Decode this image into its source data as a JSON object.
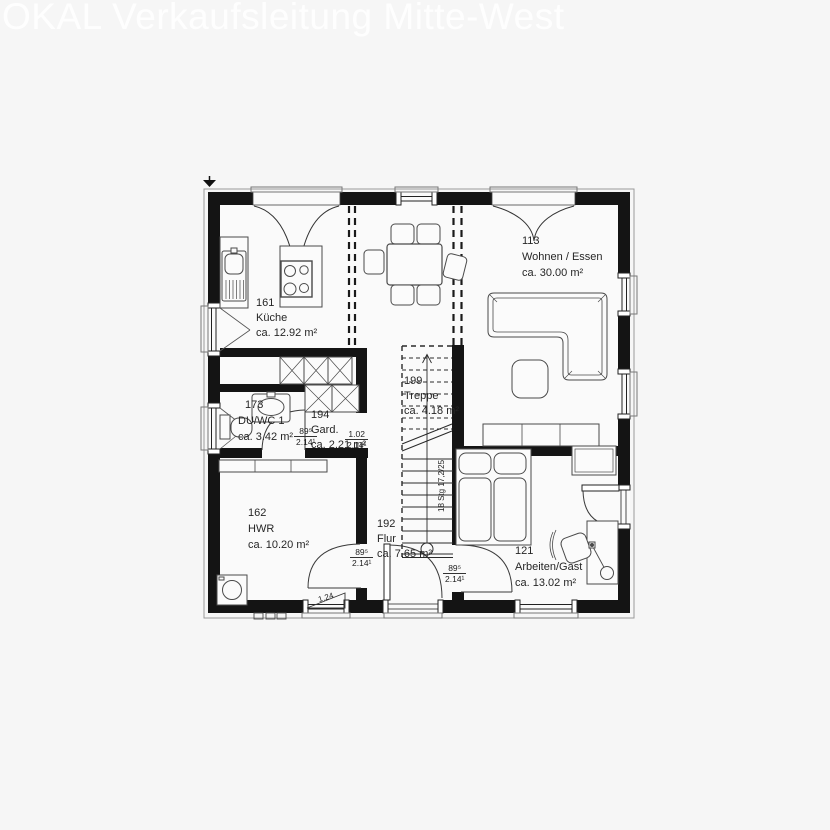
{
  "watermark": "OKAL Verkaufsleitung Mitte-West",
  "rooms": {
    "kueche": {
      "number": "161",
      "name": "Küche",
      "area": "ca. 12.92 m²"
    },
    "wohnen_essen": {
      "number": "113",
      "name": "Wohnen / Essen",
      "area": "ca. 30.00 m²"
    },
    "du_wc": {
      "number": "173",
      "name": "DU/WC 1",
      "area": "ca. 3.42 m²"
    },
    "garderobe": {
      "number": "194",
      "name": "Gard.",
      "area": "ca. 2.21 m²"
    },
    "hwr": {
      "number": "162",
      "name": "HWR",
      "area": "ca. 10.20 m²"
    },
    "flur": {
      "number": "192",
      "name": "Flur",
      "area": "ca. 7.65 m²"
    },
    "treppe": {
      "number": "199",
      "name": "Treppe",
      "area": "ca. 4.18 m²"
    },
    "arbeiten_gast": {
      "number": "121",
      "name": "Arbeiten/Gast",
      "area": "ca. 13.02 m²"
    }
  },
  "annotations": {
    "door_width": "89⁵",
    "door_height": "2.14¹",
    "opening_width": "1.02",
    "window_width": "1.24",
    "stairs_note": "18 Stg 17,2/25"
  },
  "colors": {
    "background": "#f6f6f6",
    "walls": "#141414",
    "lines": "#3a3a3a",
    "watermark": "#ffffff"
  }
}
